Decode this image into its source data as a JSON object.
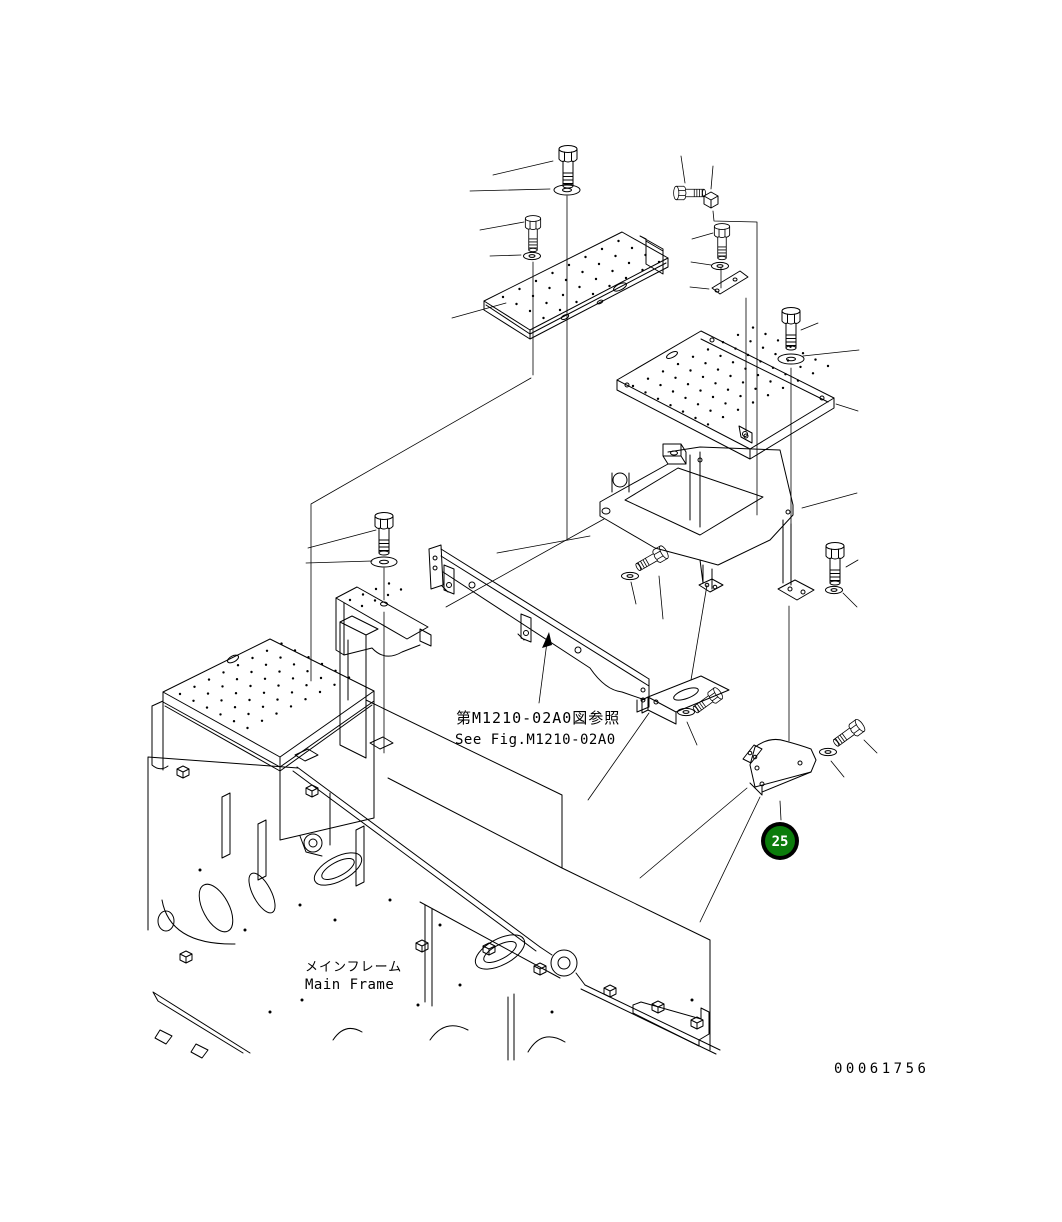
{
  "diagram": {
    "reference_note": {
      "line1_jp": "第M1210-02A0図参照",
      "line2_en": "See Fig.M1210-02A0"
    },
    "main_frame_label": {
      "jp": "メインフレーム",
      "en": "Main Frame"
    },
    "drawing_number": "00061756",
    "callout_25": {
      "number": "25",
      "fill": "#0b7c0b",
      "ring": "#000000",
      "text_color": "#ffffff"
    },
    "colors": {
      "line": "#000000",
      "background": "#ffffff"
    }
  }
}
